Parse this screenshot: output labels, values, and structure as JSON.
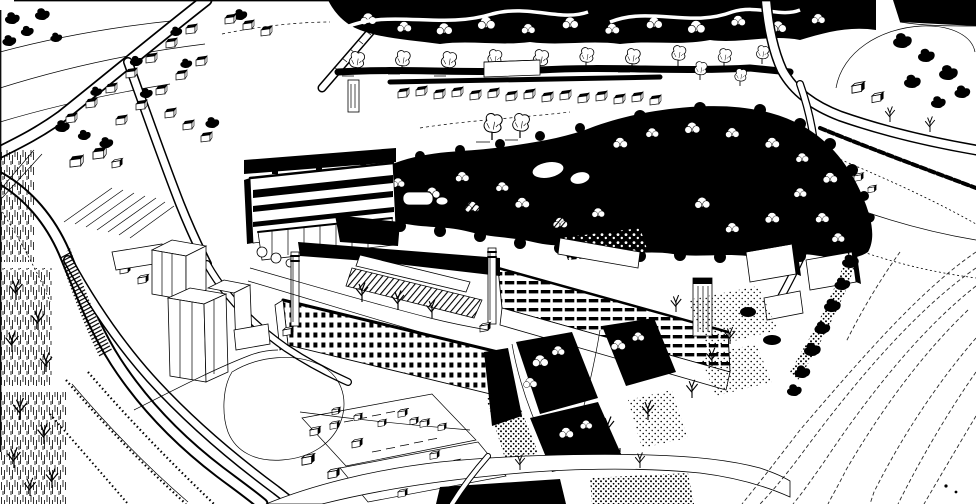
{
  "illustration": {
    "medium": "pen-and-ink aerial perspective drawing",
    "colors": {
      "paper": "#ffffff",
      "ink": "#000000"
    },
    "regions": {
      "north": "wooded ridge, hedgerows and rows of suburban houses",
      "center": "dark tree-covered hillside crescent with pond and clearings",
      "west": "college block, twin chimneys and long factory ranges",
      "east": "farmland, country road junction and field boundaries",
      "south": "tower blocks, sweeping roads, car parks, campus lawns and railway sidings"
    }
  }
}
